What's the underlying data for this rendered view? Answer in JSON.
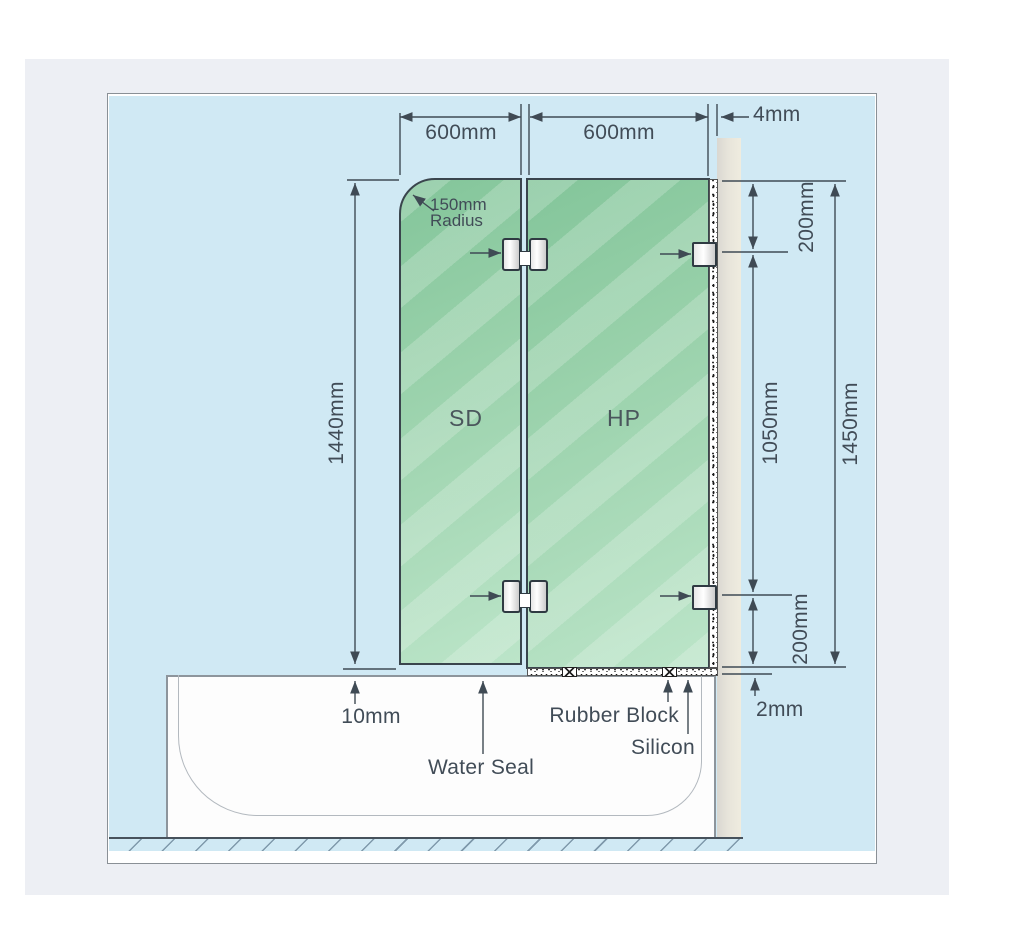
{
  "diagram_title": "Over-bath shower screen installation diagram",
  "dims": {
    "sd_width": "600mm",
    "hp_width": "600mm",
    "wall_gap": "4mm",
    "radius_line1": "150mm",
    "radius_line2": "Radius",
    "panel_height": "1440mm",
    "top_offset": "200mm",
    "mid_span": "1050mm",
    "overall_height": "1450mm",
    "bottom_offset": "200mm",
    "bottom_gap": "10mm",
    "floor_gap": "2mm"
  },
  "panels": {
    "shower_door": "SD",
    "hinge_panel": "HP"
  },
  "callouts": {
    "water_seal": "Water Seal",
    "rubber_block": "Rubber Block",
    "silicon": "Silicon"
  },
  "colors": {
    "background_blue": "#d0e9f4",
    "glass_green_dark": "#83c59a",
    "glass_green_light": "#bce5c9",
    "wall_grey": "#e7e4da",
    "line_dark": "#3f4a54",
    "page_grey": "#edeff4"
  }
}
